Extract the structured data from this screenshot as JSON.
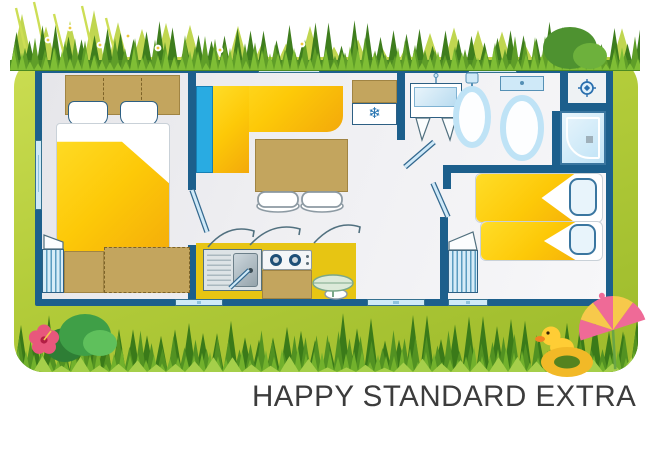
{
  "caption": "HAPPY STANDARD EXTRA",
  "icons": {
    "fridge_snowflake": "❄",
    "shower_head": "crosshair-circle"
  },
  "palette": {
    "wall_blue": "#1c5f8c",
    "bed_yellow": "#fdc908",
    "counter_yellow": "#e7c513",
    "cushion_blue": "#29abe2",
    "furniture_tan": "#c3a55e",
    "fixture_blue": "#cfe9f8",
    "frame_green": "#b3cc3a",
    "grass_dark": "#3e7d1d",
    "caption_text": "#3c3c3c"
  },
  "floorplan": {
    "rooms": [
      {
        "name": "master-bedroom",
        "furniture": [
          "double-bed",
          "headboard-shelf",
          "two-pillows",
          "wardrobe",
          "storage-cabinet",
          "dashed-storage"
        ]
      },
      {
        "name": "living-kitchen",
        "furniture": [
          "corner-bench",
          "blue-cushion",
          "dining-table",
          "two-chairs",
          "overhead-cabinet",
          "fridge",
          "sink-unit",
          "hob",
          "bar-table",
          "stool"
        ]
      },
      {
        "name": "bathroom",
        "furniture": [
          "vanity-mirror",
          "washbasin",
          "toilet",
          "shower-cubicle",
          "shower-tray"
        ]
      },
      {
        "name": "twin-bedroom",
        "furniture": [
          "single-bed",
          "single-bed",
          "wardrobe"
        ]
      }
    ],
    "openings": [
      "left-window",
      "top-window-living",
      "top-window-bath",
      "bottom-window-kitchen",
      "bottom-door-hall",
      "bottom-window-bedroom"
    ]
  },
  "decor": [
    "tall-grass",
    "daisies",
    "bush",
    "hibiscus-flower",
    "rubber-duck-swim-ring",
    "beach-parasol"
  ]
}
